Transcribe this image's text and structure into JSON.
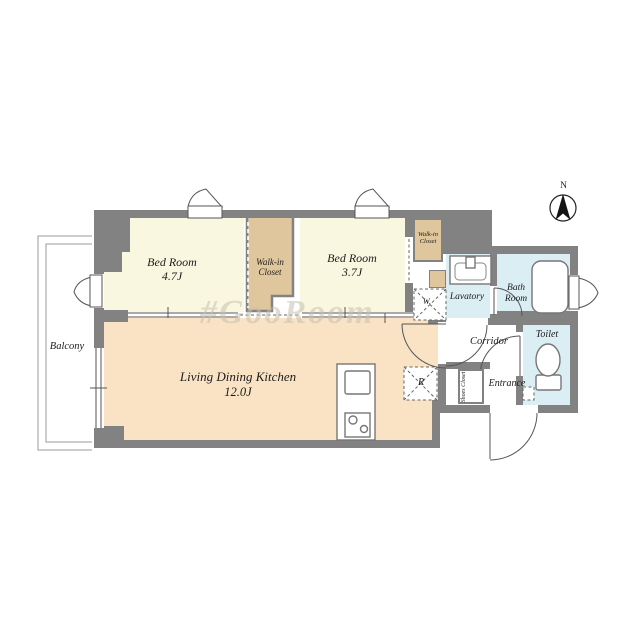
{
  "meta": {
    "watermark": "#GooRoom",
    "compass_label": "N"
  },
  "rooms": {
    "bedroom1": {
      "name": "Bed Room",
      "size": "4.7J"
    },
    "bedroom2": {
      "name": "Bed Room",
      "size": "3.7J"
    },
    "wic1": {
      "line1": "Walk-in",
      "line2": "Closet"
    },
    "wic2": {
      "line1": "Walk-in",
      "line2": "Closet"
    },
    "ldk": {
      "name": "Living Dining Kitchen",
      "size": "12.0J"
    },
    "lavatory": {
      "name": "Lavatory"
    },
    "bathroom": {
      "line1": "Bath",
      "line2": "Room"
    },
    "toilet": {
      "name": "Toilet"
    },
    "corridor": {
      "name": "Corridor"
    },
    "entrance": {
      "name": "Entrance"
    },
    "shoes_closet": {
      "line1": "Shoes",
      "line2": "Closet"
    },
    "balcony": {
      "name": "Balcony"
    },
    "washer": {
      "label": "W."
    },
    "refrigerator": {
      "label": "R"
    }
  },
  "colors": {
    "wall": "#828282",
    "bedroom_fill": "#faf7e0",
    "closet_fill": "#e0c69c",
    "ldk_fill": "#f9e3c4",
    "wet_fill": "#daeef3",
    "line": "#555555"
  }
}
